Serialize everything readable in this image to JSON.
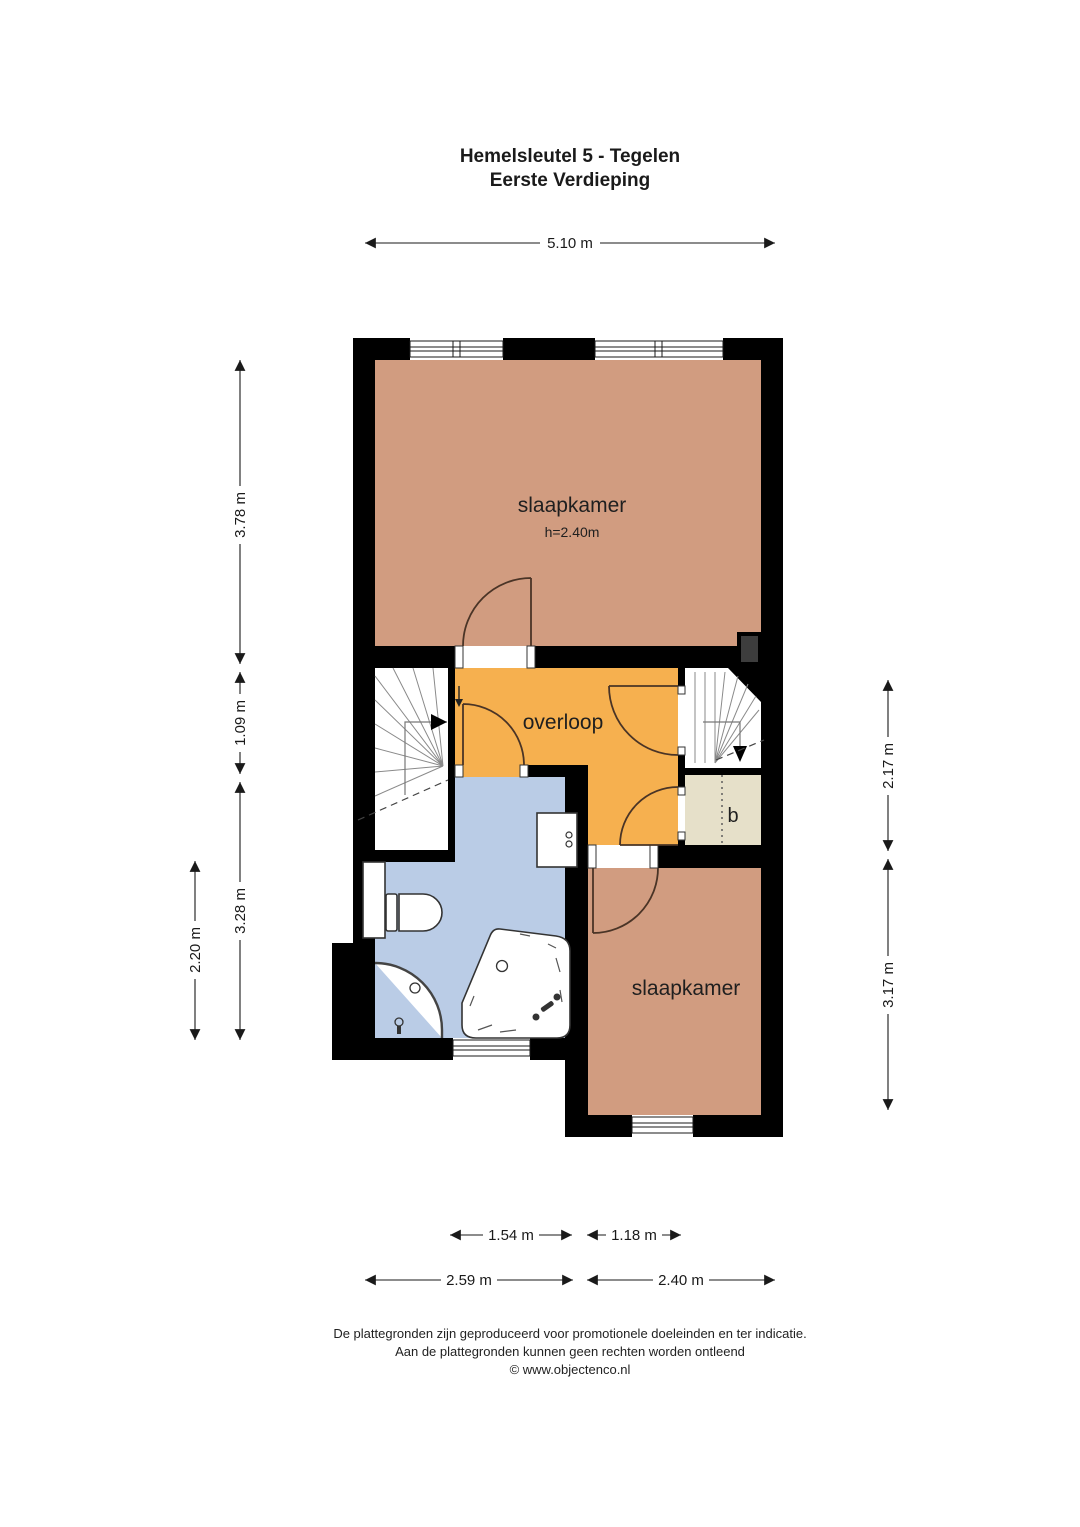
{
  "title": {
    "line1": "Hemelsleutel 5 - Tegelen",
    "line2": "Eerste Verdieping"
  },
  "rooms": {
    "bedroom_top": {
      "label": "slaapkamer",
      "height_note": "h=2.40m",
      "color": "#D19C80"
    },
    "landing": {
      "label": "overloop",
      "color": "#F6B04F"
    },
    "bathroom": {
      "color": "#BACCE6"
    },
    "closet": {
      "label": "b",
      "color": "#E6E0C9"
    },
    "bedroom_bottom": {
      "label": "slaapkamer",
      "color": "#D19C80"
    }
  },
  "dimensions": {
    "top_width": "5.10 m",
    "left_outer": [
      "3.78 m",
      "1.09 m",
      "3.28 m"
    ],
    "left_inner": "2.20 m",
    "right": [
      "2.17 m",
      "3.17 m"
    ],
    "bottom_inner": [
      "1.54 m",
      "1.18 m"
    ],
    "bottom_outer": [
      "2.59 m",
      "2.40 m"
    ]
  },
  "footer": {
    "line1": "De plattegronden zijn geproduceerd voor promotionele doeleinden en ter indicatie.",
    "line2": "Aan de plattegronden kunnen geen rechten worden ontleend",
    "line3": "© www.objectenco.nl"
  },
  "wall_color": "#000000"
}
